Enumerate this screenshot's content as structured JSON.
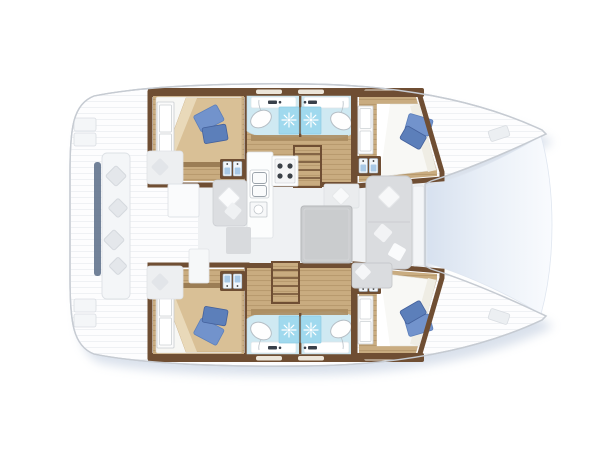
{
  "diagram": {
    "type": "boat-floor-plan",
    "subject": "catamaran deck layout, top view",
    "orientation": "bow-right",
    "hulls": 2,
    "cabins": [
      {
        "id": "port-aft-cabin",
        "position": "top-left",
        "features": [
          "double-bed",
          "tan-blanket",
          "blue-pillow",
          "wardrobe"
        ]
      },
      {
        "id": "port-forward-cabin",
        "position": "top-right",
        "features": [
          "double-bed",
          "blue-pillow",
          "wardrobe"
        ]
      },
      {
        "id": "starboard-aft-cabin",
        "position": "bottom-left",
        "features": [
          "double-bed",
          "tan-blanket",
          "blue-pillow",
          "wardrobe"
        ]
      },
      {
        "id": "starboard-forward-cabin",
        "position": "bottom-right",
        "features": [
          "double-bed",
          "blue-pillow",
          "wardrobe"
        ]
      }
    ],
    "bathrooms": [
      {
        "id": "port-aft-head",
        "fixtures": [
          "toilet",
          "shower",
          "sink-counter"
        ]
      },
      {
        "id": "port-forward-head",
        "fixtures": [
          "toilet",
          "shower",
          "sink-counter"
        ]
      },
      {
        "id": "starboard-aft-head",
        "fixtures": [
          "toilet",
          "shower",
          "sink-counter"
        ]
      },
      {
        "id": "starboard-forward-head",
        "fixtures": [
          "toilet",
          "shower",
          "sink-counter"
        ]
      }
    ],
    "saloon": {
      "features": [
        "galley-counter",
        "double-sink",
        "stove-4-burner",
        "oven",
        "dining-table",
        "u-shaped-sofa",
        "bench-seat",
        "storage-cabinets"
      ]
    },
    "cockpit": {
      "features": [
        "side-bench-with-cushions",
        "cockpit-table",
        "corner-seats",
        "transom-steps"
      ]
    },
    "stairs": [
      "port-companionway-steps",
      "starboard-companionway-steps"
    ],
    "foredeck": "trampoline-net-between-bows"
  },
  "colors": {
    "wall_wood": "#6f4e33",
    "floor_wood": "#c9ac80",
    "floor_wood_line": "#b5976b",
    "bath_floor": "#cfe9f2",
    "shower_tile": "#a0d9ee",
    "pillow_blue": "#7293cc",
    "pillow_blue_dark": "#5c7fba",
    "blanket_tan": "#d9c096",
    "sofa_gray": "#dadcdf",
    "deck_white": "#fdfdfe",
    "deck_line": "#e6e9ed",
    "hull_outline": "#c6cbd2",
    "shadow_blue": "#9db0cc",
    "tramp_dark": "#d7e1ef",
    "tramp_light": "#f9fbfe",
    "door_blue": "#a9c9e6"
  }
}
